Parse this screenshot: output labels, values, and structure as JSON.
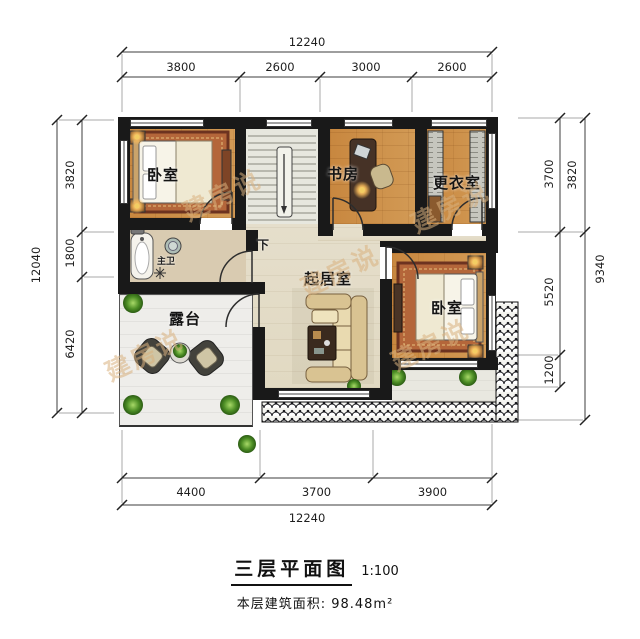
{
  "title": {
    "heading": "三层平面图",
    "scale": "1:100",
    "area_label": "本层建筑面积:",
    "area_value": "98.48m²"
  },
  "watermark": {
    "text": "建房说"
  },
  "rooms": {
    "bedroom1": "卧室",
    "study": "书房",
    "dressing": "更衣室",
    "living": "起居室",
    "bedroom2": "卧室",
    "terrace": "露台",
    "bath": "主卫",
    "stairs_down": "下"
  },
  "dimensions": {
    "top": {
      "overall": "12240",
      "segments": [
        "3800",
        "2600",
        "3000",
        "2600"
      ]
    },
    "bottom": {
      "overall": "12240",
      "segments": [
        "4400",
        "3700",
        "3900"
      ]
    },
    "left": {
      "overall": "12040",
      "segments": [
        "3820",
        "1800",
        "6420"
      ]
    },
    "right": {
      "inner": [
        "3700",
        "5520",
        "1200"
      ],
      "outer": [
        "3820",
        "9340"
      ]
    }
  },
  "colors": {
    "wall": "#191919",
    "wood_floor": "#c8873f",
    "hall_floor": "#e5decb",
    "rug": "#b4663a",
    "watermark": "#d8b07e"
  }
}
